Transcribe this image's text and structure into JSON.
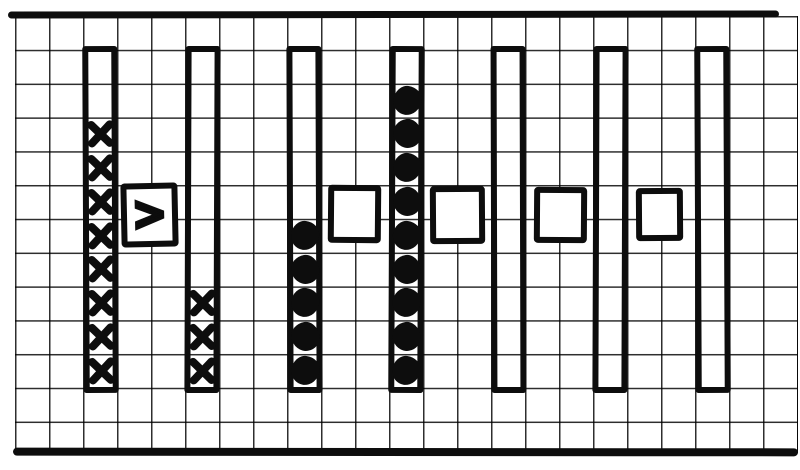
{
  "diagram": {
    "paper_color": "#ffffff",
    "ink_color": "#0d0d0d",
    "grid": {
      "cell_px": 34,
      "columns": 23,
      "rows": 13
    },
    "bars": [
      {
        "name": "bar-1",
        "rows": 10,
        "mark": "x",
        "mark_count": 8
      },
      {
        "name": "bar-2",
        "rows": 10,
        "mark": "x",
        "mark_count": 3
      },
      {
        "name": "bar-3",
        "rows": 10,
        "mark": "dot",
        "mark_count": 5
      },
      {
        "name": "bar-4",
        "rows": 10,
        "mark": "dot",
        "mark_count": 9
      },
      {
        "name": "bar-5",
        "rows": 10,
        "mark": "none",
        "mark_count": 0
      },
      {
        "name": "bar-6",
        "rows": 10,
        "mark": "none",
        "mark_count": 0
      },
      {
        "name": "bar-7",
        "rows": 10,
        "mark": "none",
        "mark_count": 0
      }
    ],
    "comparison_boxes": [
      {
        "name": "comparison-box-1",
        "between": [
          "bar-1",
          "bar-2"
        ],
        "symbol": ">"
      },
      {
        "name": "comparison-box-2",
        "between": [
          "bar-3",
          "bar-4"
        ],
        "symbol": ""
      },
      {
        "name": "comparison-box-3",
        "between": [
          "bar-4",
          "bar-5"
        ],
        "symbol": ""
      },
      {
        "name": "comparison-box-4",
        "between": [
          "bar-5",
          "bar-6"
        ],
        "symbol": ""
      },
      {
        "name": "comparison-box-5",
        "between": [
          "bar-6",
          "bar-7"
        ],
        "symbol": ""
      }
    ]
  }
}
